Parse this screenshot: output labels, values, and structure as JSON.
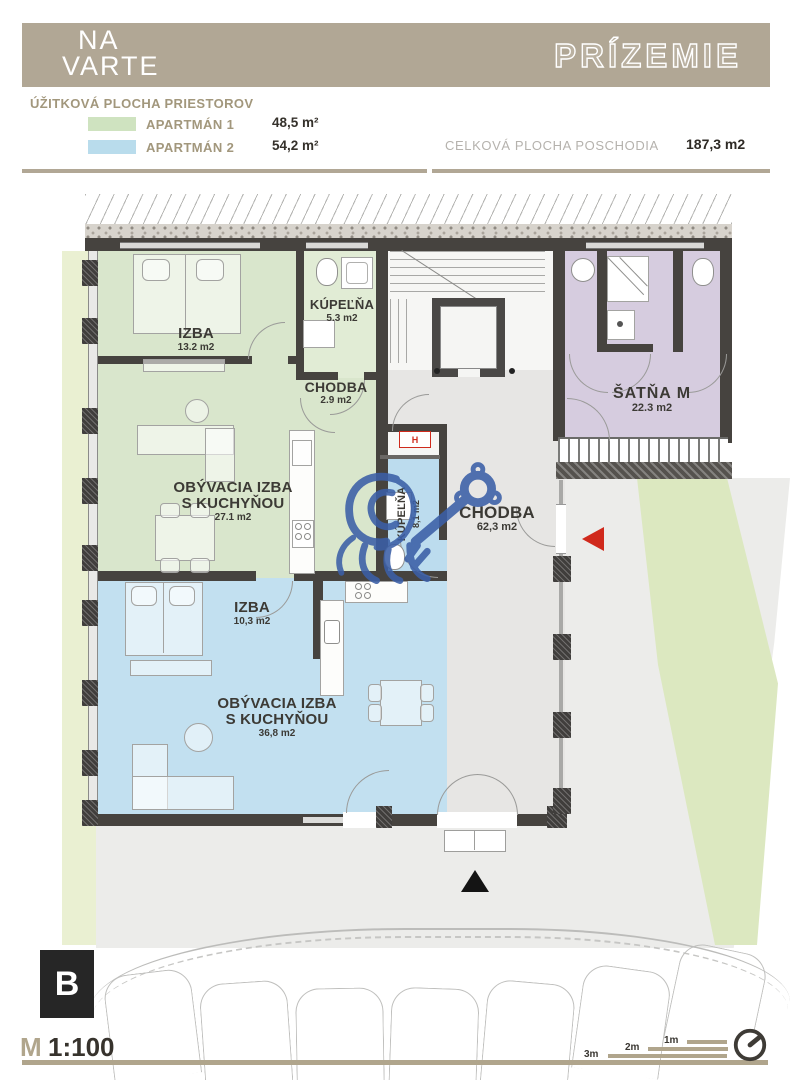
{
  "header": {
    "logo_line1": "NA",
    "logo_line2": "VARTE",
    "title": "PRÍZEMIE"
  },
  "legend": {
    "heading": "ÚŽITKOVÁ PLOCHA PRIESTOROV",
    "apartments": [
      {
        "label": "APARTMÁN 1",
        "area": "48,5 m²",
        "swatch_color": "#cfe3c0"
      },
      {
        "label": "APARTMÁN 2",
        "area": "54,2 m²",
        "swatch_color": "#b9dcec"
      }
    ],
    "total_label": "CELKOVÁ PLOCHA POSCHODIA",
    "total_value": "187,3 m2"
  },
  "floorplan": {
    "rooms": [
      {
        "name": "IZBA",
        "area": "13.2 m2",
        "apartment": 1
      },
      {
        "name": "KÚPEĽŇA",
        "area": "5.3 m2",
        "apartment": 1
      },
      {
        "name": "CHODBA",
        "area": "2.9 m2",
        "apartment": 1
      },
      {
        "name": "OBÝVACIA IZBA",
        "name2": "S KUCHYŇOU",
        "area": "27.1 m2",
        "apartment": 1
      },
      {
        "name": "IZBA",
        "area": "10,3 m2",
        "apartment": 2
      },
      {
        "name": "KÚPEĽŇA",
        "area": "8,1 m2",
        "apartment": 2
      },
      {
        "name": "OBÝVACIA IZBA",
        "name2": "S KUCHYŇOU",
        "area": "36,8 m2",
        "apartment": 2
      },
      {
        "name": "CHODBA",
        "area": "62,3 m2",
        "apartment": null
      },
      {
        "name": "ŠATŇA M",
        "area": "22.3 m2",
        "apartment": null
      }
    ],
    "technical_label": "H",
    "colors": {
      "apartment1_fill": "#d9e6cc",
      "apartment2_fill": "#c2e0f0",
      "satna_fill": "#d6ccdf",
      "hallway_fill": "#e7e6e4",
      "wall": "#46433f",
      "entry_marker_red": "#d0291c",
      "watermark_blue": "#3b5fa7",
      "header_tan": "#b1a795"
    }
  },
  "footer": {
    "section_marker": "B",
    "scale_prefix": "M",
    "scale_value": "1:100",
    "scale_bar_labels": [
      "1m",
      "2m",
      "3m"
    ]
  }
}
